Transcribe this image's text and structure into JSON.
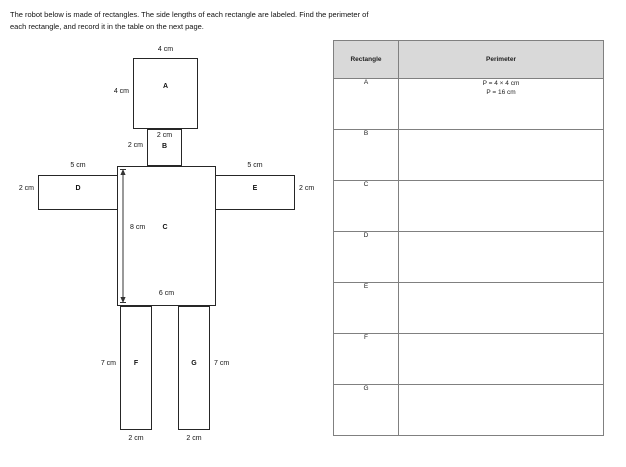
{
  "page": {
    "instructions_line1": "The robot below is made of rectangles.  The side lengths of each rectangle are labeled.  Find the perimeter of",
    "instructions_line2": "each rectangle, and record it in the table on the next page."
  },
  "figure": {
    "a_label": "A",
    "a_width": "4 cm",
    "a_height": "4 cm",
    "b_label": "B",
    "b_width": "2 cm",
    "b_height": "2 cm",
    "c_label": "C",
    "c_height": "8 cm",
    "c_width": "6 cm",
    "d_label": "D",
    "d_width": "5 cm",
    "d_height": "2 cm",
    "e_label": "E",
    "e_width": "5 cm",
    "e_height": "2 cm",
    "f_label": "F",
    "f_height": "7 cm",
    "f_width": "2 cm",
    "g_label": "G",
    "g_height": "7 cm",
    "g_width": "2 cm"
  },
  "table": {
    "headers": {
      "rectangle": "Rectangle",
      "perimeter": "Perimeter"
    },
    "rows": [
      {
        "label": "A",
        "perimeter_line1": "P = 4 × 4 cm",
        "perimeter_line2": "P =  16 cm"
      },
      {
        "label": "B",
        "perimeter_line1": "",
        "perimeter_line2": ""
      },
      {
        "label": "C",
        "perimeter_line1": "",
        "perimeter_line2": ""
      },
      {
        "label": "D",
        "perimeter_line1": "",
        "perimeter_line2": ""
      },
      {
        "label": "E",
        "perimeter_line1": "",
        "perimeter_line2": ""
      },
      {
        "label": "F",
        "perimeter_line1": "",
        "perimeter_line2": ""
      },
      {
        "label": "G",
        "perimeter_line1": "",
        "perimeter_line2": ""
      }
    ]
  },
  "colors": {
    "header_fill": "#d9d9d9",
    "table_border": "#808080",
    "figure_line": "#262626"
  }
}
